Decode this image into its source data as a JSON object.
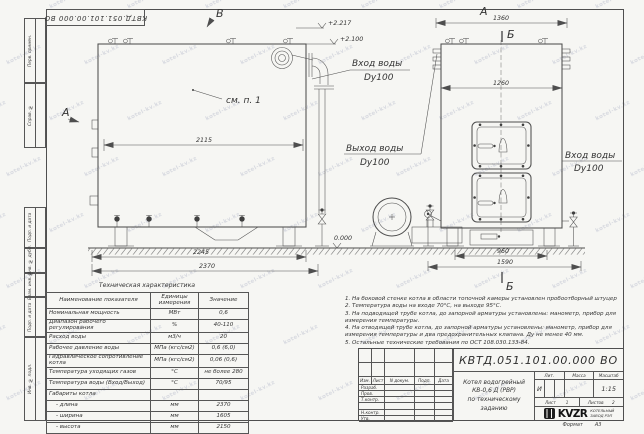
{
  "watermark": {
    "text": "kotel-kv.kz"
  },
  "stamp_top": {
    "doc_number": "КВТД.051.101.00.000 ВО"
  },
  "frame": {
    "margin_labels": [
      "Перв. примен.",
      "Справ. №",
      "Подп. и дата",
      "Инв. № дубл.",
      "Взам. инв. №",
      "Подп. и дата",
      "Инв. № подл."
    ],
    "format_label": "Формат",
    "format_value": "А3"
  },
  "drawing": {
    "view_labels": {
      "side_top": "В",
      "side_left": "А",
      "front_top": "А",
      "section_top": "Б",
      "section_bottom": "Б"
    },
    "callout": "см. п. 1",
    "dims": {
      "side_top": "2115",
      "side_mid": "2245",
      "side_bottom": "2370",
      "front_top": "1360",
      "front_inner": "1260",
      "front_base_inner": "960",
      "front_base_outer": "1590"
    },
    "elevations": {
      "top": "+2.217",
      "mid": "+2.100",
      "ground": "0.000"
    },
    "labels": {
      "inlet_side": {
        "line1": "Вход воды",
        "line2": "Dy100"
      },
      "outlet": {
        "line1": "Выход воды",
        "line2": "Dy100"
      },
      "inlet_front": {
        "line1": "Вход воды",
        "line2": "Dy100"
      }
    }
  },
  "spec_table": {
    "title": "Техническая характеристика",
    "headers": [
      "Наименование показателя",
      "Единицы измерения",
      "Значение"
    ],
    "rows": [
      [
        "Номинальная мощность",
        "МВт",
        "0,6"
      ],
      [
        "Диапазон рабочего регулирования",
        "%",
        "40-110"
      ],
      [
        "Расход воды",
        "м3/ч",
        "20"
      ],
      [
        "Рабочее давление воды",
        "МПа (кгс/см2)",
        "0,6 (6,0)"
      ],
      [
        "Гидравлическое сопротивление котла",
        "МПа (кгс/см2)",
        "0,06 (0,6)"
      ],
      [
        "Температура уходящих газов",
        "°С",
        "не более 280"
      ],
      [
        "Температура воды (Вход/Выход)",
        "°С",
        "70/95"
      ],
      [
        "Габариты котла",
        "",
        ""
      ],
      [
        "- длина",
        "мм",
        "2370"
      ],
      [
        "- ширина",
        "мм",
        "1605"
      ],
      [
        "- высота",
        "мм",
        "2150"
      ]
    ]
  },
  "notes": [
    "1.  На боковой стенке котла в области топочной камеры установлен пробоотборный штуцер",
    "2.  Температура воды на входе 70°С, на выходе 95°С.",
    "3.  На подводящей трубе котла, до запорной арматуры установлены: манометр, прибор для измерения температуры.",
    "4.  На отводящей трубе котла, до запорной арматуры установлены: манометр, прибор для измерения температуры и два предохранительных клапана. Ду не менее 40 мм.",
    "5.  Остальные технические требования по ОСТ 108.030.133-84."
  ],
  "title_block": {
    "doc_number": "КВТД.051.101.00.000 ВО",
    "title_line1": "Котел водогрейный",
    "title_line2": "КВ-0,6 Д (РВР)",
    "title_line3": "по техническому заданию",
    "header_cols": [
      "Изм.",
      "Лист",
      "N докум.",
      "Подп.",
      "Дата"
    ],
    "sig_rows": [
      "Разраб.",
      "Пров.",
      "Т.контр.",
      "",
      "Н.контр.",
      "Утв."
    ],
    "lit_label": "Лит.",
    "lit_value": "И",
    "mass_label": "Масса",
    "scale_label": "Масштаб",
    "scale_value": "1:15",
    "sheet_label": "Лист",
    "sheet_value": "1",
    "sheets_label": "Листов",
    "sheets_value": "2",
    "company_logo": "KVZR",
    "company_name_line1": "КОТЕЛЬНЫЙ",
    "company_name_line2": "ЗАВОД РЭП"
  }
}
